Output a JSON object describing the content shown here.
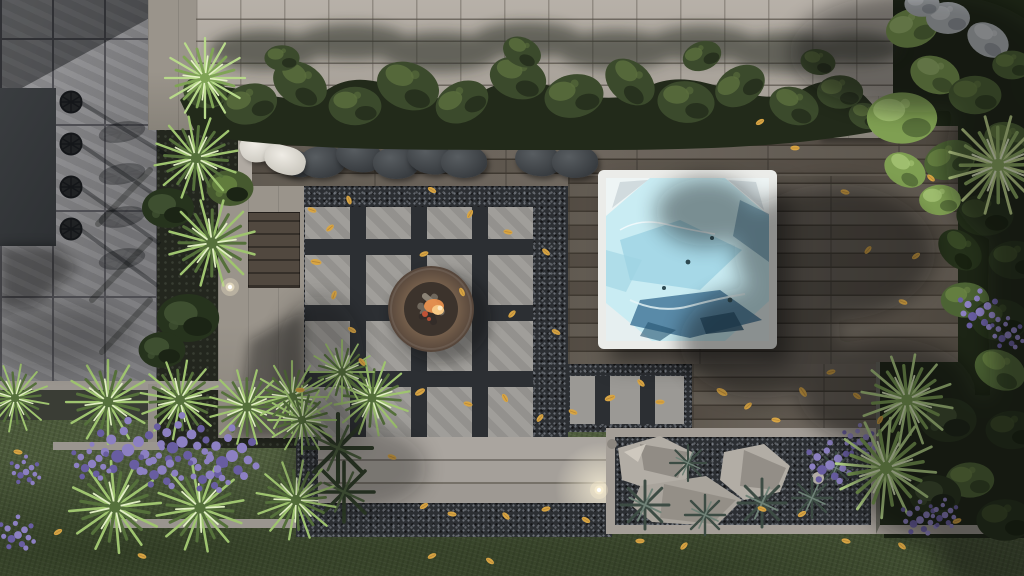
{
  "scene": {
    "view": "top-down backyard landscape render",
    "objects": [
      "stone-tile-patio",
      "dining-table",
      "dining-chair",
      "ornamental-grass",
      "lavender-plant",
      "boxwood-hedge",
      "house-siding-wall",
      "wood-deck",
      "outdoor-cushion",
      "white-pillow",
      "hot-tub",
      "paver-grid-patio",
      "fire-pit",
      "garden-steps",
      "rock-planter-bed",
      "lawn",
      "side-garden",
      "fallen-leaf",
      "landscape-light",
      "concrete-planter-wall",
      "wood-storage-box"
    ],
    "counts": {
      "dining_chairs": 4,
      "dark_cushions": 8,
      "white_pillows": 2,
      "landscape_lights": 2,
      "boulders": 3
    }
  },
  "palette": {
    "lawn": "#4a5839",
    "tile": "#8c8c8f",
    "tile_joint": "#4f4f54",
    "wall": "#b3aca3",
    "soil_dark": "#23261e",
    "deck": "#60584e",
    "deck_gap": "#3f3931",
    "paver": "#9b9995",
    "gravel": "#2c2f33",
    "concrete": "#938e88",
    "concrete_light": "#a8a39d",
    "table": "#34373a",
    "chair": "#141619",
    "cushion": "#45494d",
    "pillow": "#e4e1da",
    "tub_frame": "#ebece9",
    "water": "#c9ecf3",
    "water_mid": "#9ed3e3",
    "water_dark": "#45799a",
    "water_deep": "#27536f",
    "hedge_dark": "#222a1a",
    "hedge_mid": "#3b4a2c",
    "hedge_light": "#5c6f3e",
    "g1": "#9fc46f",
    "g2": "#55703b",
    "g3": "#e2efc4",
    "bush_dark": "#26331d",
    "bush_mid": "#415233",
    "garden_dark": "#1c2415",
    "garden_mid": "#4c6334",
    "garden_light": "#7f9f52",
    "garden_bright": "#a7c677",
    "silver": "#b7bcc0",
    "lavender": "#8c80c2",
    "lavender_dark": "#685da1",
    "tuft": "#3d4c44",
    "tuft_light": "#6f8277",
    "rock": "#b2ada5",
    "rock_dark": "#8b867f",
    "rock_light": "#d0cbc1",
    "fire_bowl": "#76604c",
    "fire_bowl_dark": "#55453a",
    "log": "#6f675c",
    "log_dark": "#332c28",
    "flame": "#e78f4d",
    "flame_bright": "#f7c985",
    "ember": "#c05236",
    "leaf": "#d8a544",
    "leaf_dark": "#ad7e33",
    "shadow": "#0e110c",
    "glow": "#fff3d2"
  }
}
